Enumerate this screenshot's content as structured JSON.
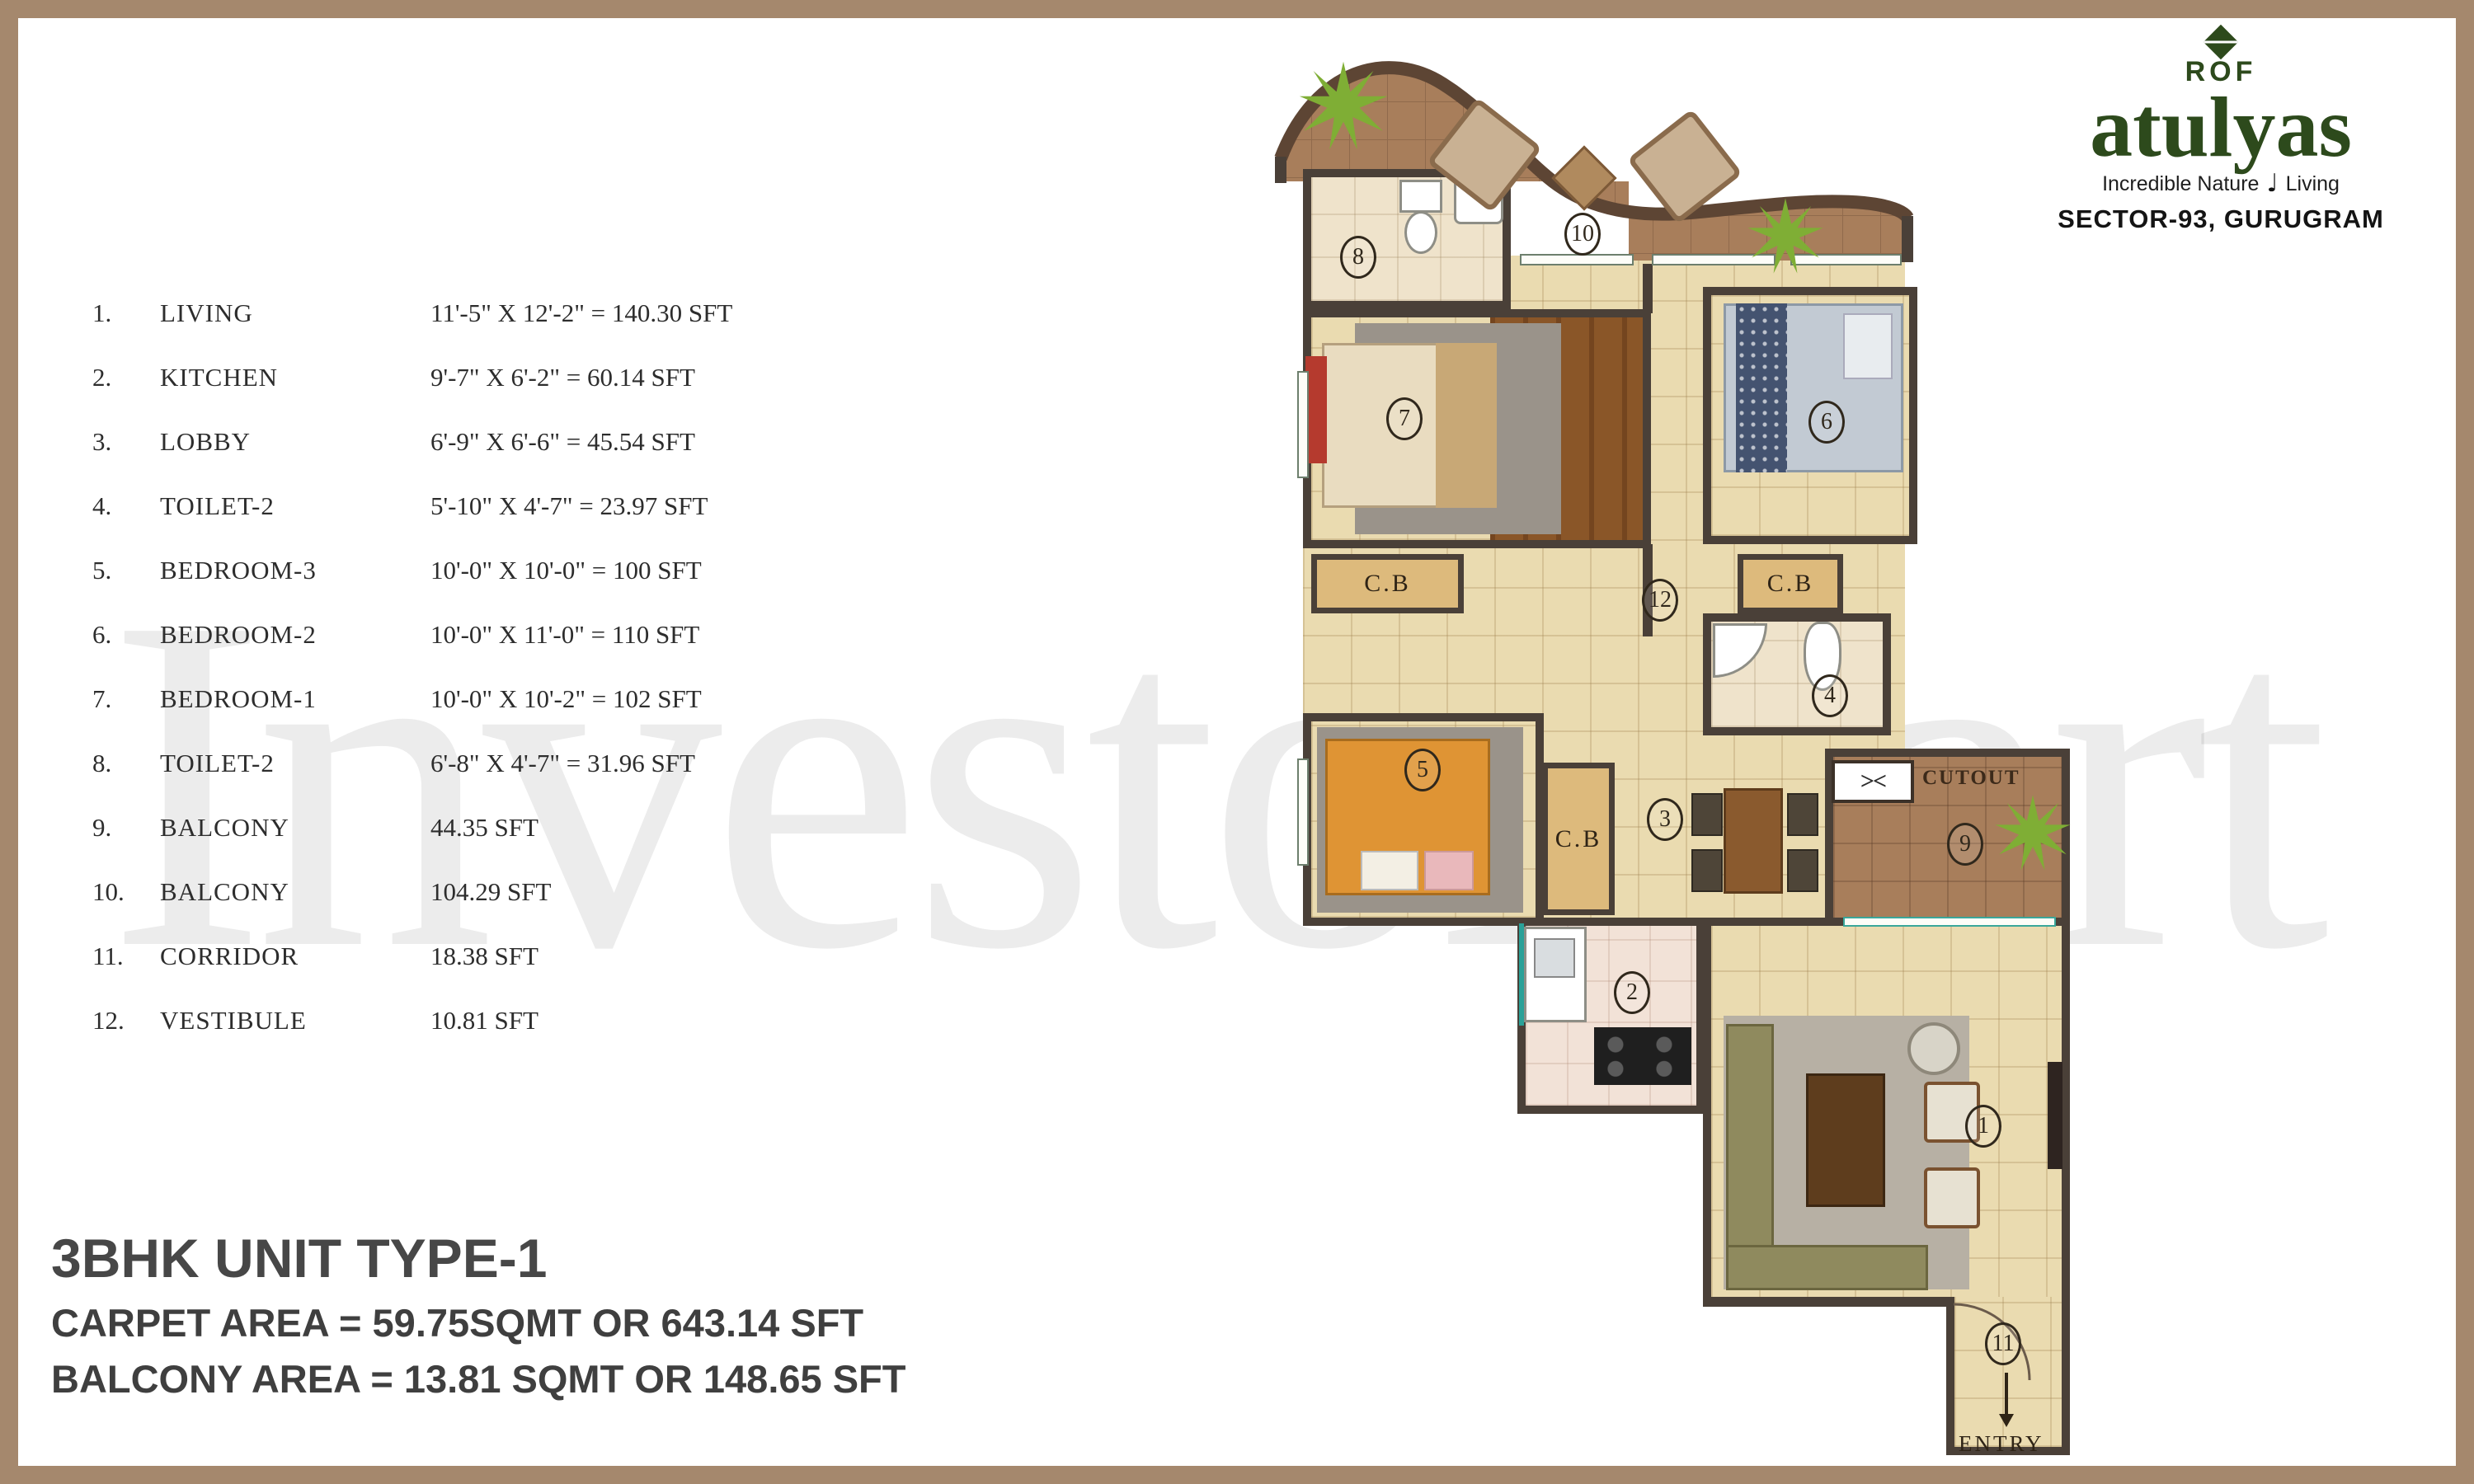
{
  "frame": {
    "border_color": "#a5886d",
    "background": "#ffffff"
  },
  "watermark": {
    "text": "InvestoMart"
  },
  "area_table": {
    "rows": [
      {
        "no": "1.",
        "name": "LIVING",
        "dims": "11'-5\" X 12'-2\" = 140.30 SFT"
      },
      {
        "no": "2.",
        "name": "KITCHEN",
        "dims": "9'-7\" X 6'-2\" = 60.14 SFT"
      },
      {
        "no": "3.",
        "name": "LOBBY",
        "dims": "6'-9\" X 6'-6\" = 45.54 SFT"
      },
      {
        "no": "4.",
        "name": "TOILET-2",
        "dims": "5'-10\" X 4'-7\" = 23.97 SFT"
      },
      {
        "no": "5.",
        "name": "BEDROOM-3",
        "dims": "10'-0\" X 10'-0\" = 100 SFT"
      },
      {
        "no": "6.",
        "name": "BEDROOM-2",
        "dims": "10'-0\" X 11'-0\" = 110 SFT"
      },
      {
        "no": "7.",
        "name": "BEDROOM-1",
        "dims": "10'-0\" X 10'-2\" = 102 SFT"
      },
      {
        "no": "8.",
        "name": "TOILET-2",
        "dims": "6'-8\" X 4'-7\" = 31.96 SFT"
      },
      {
        "no": "9.",
        "name": "BALCONY",
        "dims": "44.35 SFT"
      },
      {
        "no": "10.",
        "name": "BALCONY",
        "dims": "104.29 SFT"
      },
      {
        "no": "11.",
        "name": "CORRIDOR",
        "dims": "18.38 SFT"
      },
      {
        "no": "12.",
        "name": "VESTIBULE",
        "dims": "10.81 SFT"
      }
    ]
  },
  "title_block": {
    "unit": "3BHK UNIT TYPE-1",
    "carpet": "CARPET AREA = 59.75SQMT OR 643.14 SFT",
    "balcony": "BALCONY AREA = 13.81 SQMT OR 148.65 SFT"
  },
  "logo": {
    "rof": "ROF",
    "brand": "atulyas",
    "tagline_left": "Incredible Nature",
    "tagline_right": "Living",
    "location": "SECTOR-93, GURUGRAM",
    "green": "#2d4a1c"
  },
  "plan": {
    "labels": {
      "cb": "C.B",
      "cutout": "CUTOUT",
      "cutout_symbol": "><",
      "entry": "ENTRY"
    },
    "markers": [
      {
        "n": "1"
      },
      {
        "n": "2"
      },
      {
        "n": "3"
      },
      {
        "n": "4"
      },
      {
        "n": "5"
      },
      {
        "n": "6"
      },
      {
        "n": "7"
      },
      {
        "n": "8"
      },
      {
        "n": "9"
      },
      {
        "n": "10"
      },
      {
        "n": "11"
      },
      {
        "n": "12"
      }
    ]
  }
}
